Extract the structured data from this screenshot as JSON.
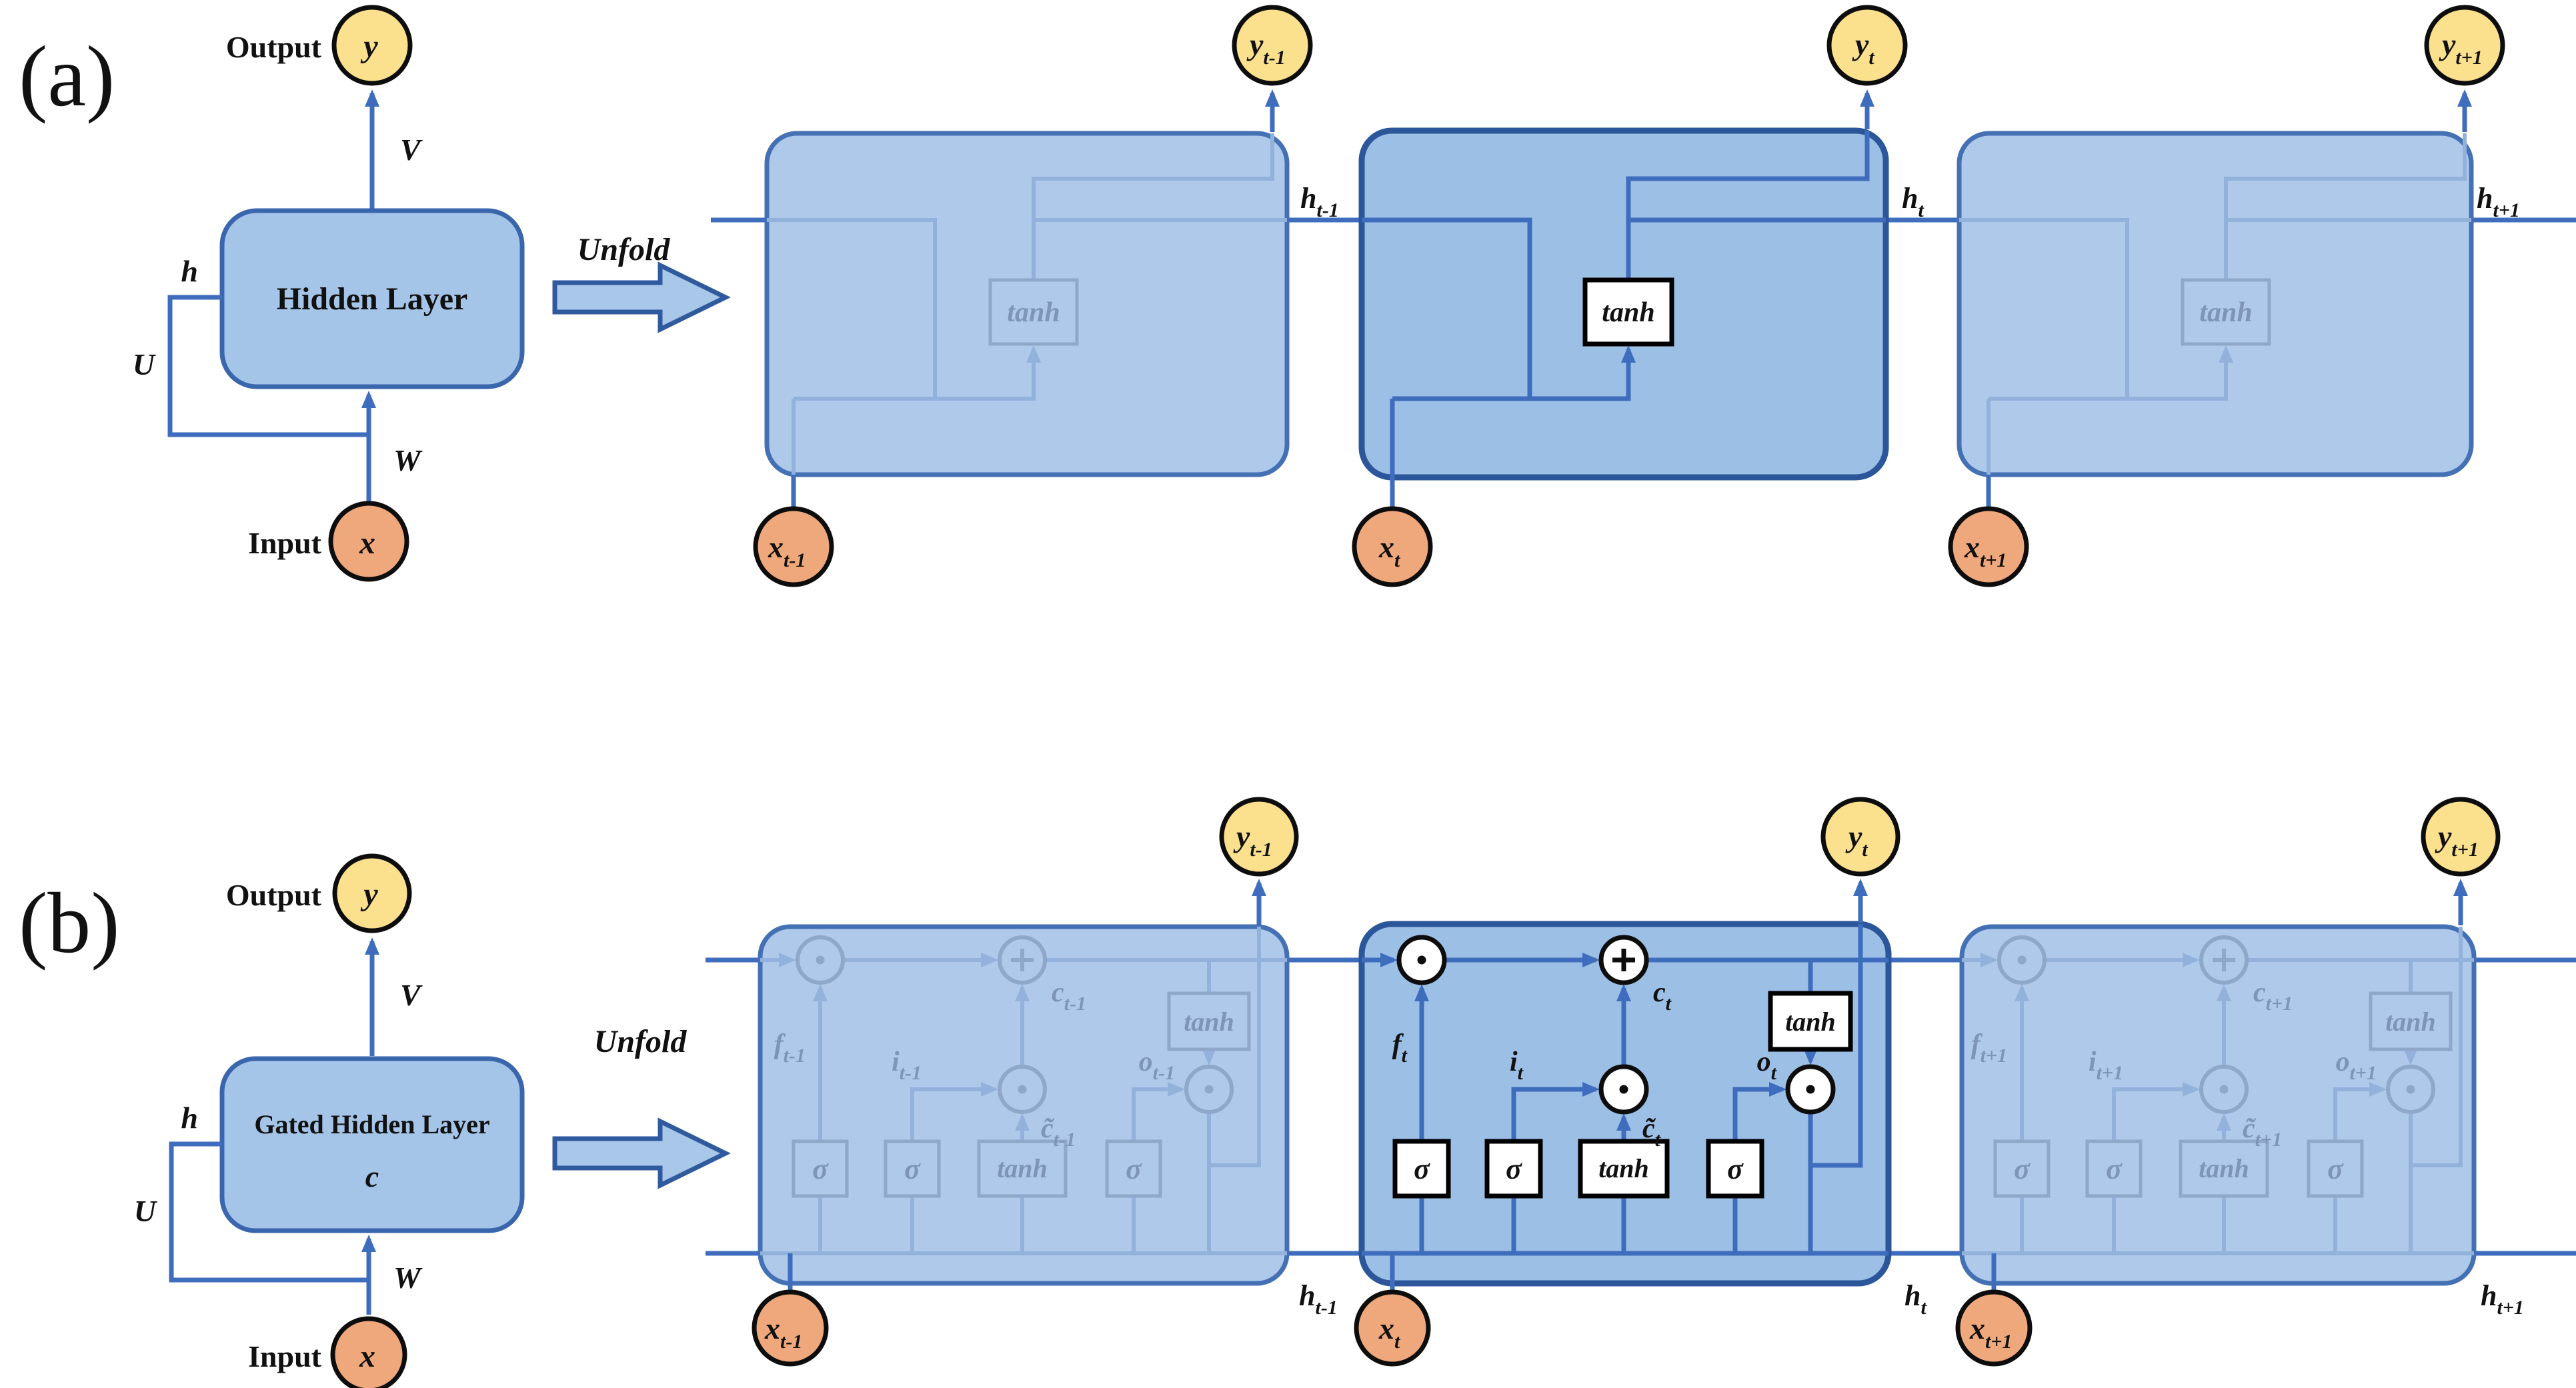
{
  "figure": {
    "description": "Recurrent neural network figure: (a) simple RNN folded and unfolded, (b) gated (LSTM) hidden layer folded and unfolded"
  },
  "panels": {
    "a": {
      "tag": "(a)",
      "folded": {
        "output": "Output",
        "input": "Input",
        "y": "y",
        "x": "x",
        "v": "V",
        "u": "U",
        "w": "W",
        "h": "h",
        "box": "Hidden Layer"
      },
      "unfold": "Unfold",
      "cells": [
        {
          "sub": "t-1",
          "tanh": "tanh",
          "y": "y",
          "x": "x",
          "h": "h"
        },
        {
          "sub": "t",
          "tanh": "tanh",
          "y": "y",
          "x": "x",
          "h": "h"
        },
        {
          "sub": "t+1",
          "tanh": "tanh",
          "y": "y",
          "x": "x",
          "h": "h"
        }
      ]
    },
    "b": {
      "tag": "(b)",
      "folded": {
        "output": "Output",
        "input": "Input",
        "y": "y",
        "x": "x",
        "v": "V",
        "u": "U",
        "w": "W",
        "h": "h",
        "box_line1": "Gated Hidden Layer",
        "box_line2": "c"
      },
      "unfold": "Unfold",
      "cells": [
        {
          "sub": "t-1",
          "f": "f",
          "i": "i",
          "o": "o",
          "c": "c",
          "c_tilde": "c̃",
          "sigma": "σ",
          "tanh": "tanh",
          "y": "y",
          "x": "x",
          "h": "h"
        },
        {
          "sub": "t",
          "f": "f",
          "i": "i",
          "o": "o",
          "c": "c",
          "c_tilde": "c̃",
          "sigma": "σ",
          "tanh": "tanh",
          "y": "y",
          "x": "x",
          "h": "h"
        },
        {
          "sub": "t+1",
          "f": "f",
          "i": "i",
          "o": "o",
          "c": "c",
          "c_tilde": "c̃",
          "sigma": "σ",
          "tanh": "tanh",
          "y": "y",
          "x": "x",
          "h": "h"
        }
      ]
    }
  },
  "colors": {
    "cell_light": "#AEC9EA",
    "cell_active": "#9CBFE5",
    "border_light": "#4470B4",
    "border_active": "#2B5699",
    "wire": "#3F6DBD",
    "wire_faded": "#93B2DB",
    "node_input": "#EFA87B",
    "node_output": "#FBE18E",
    "gate_active_bg": "#FFFFFF",
    "ink": "#111111"
  }
}
